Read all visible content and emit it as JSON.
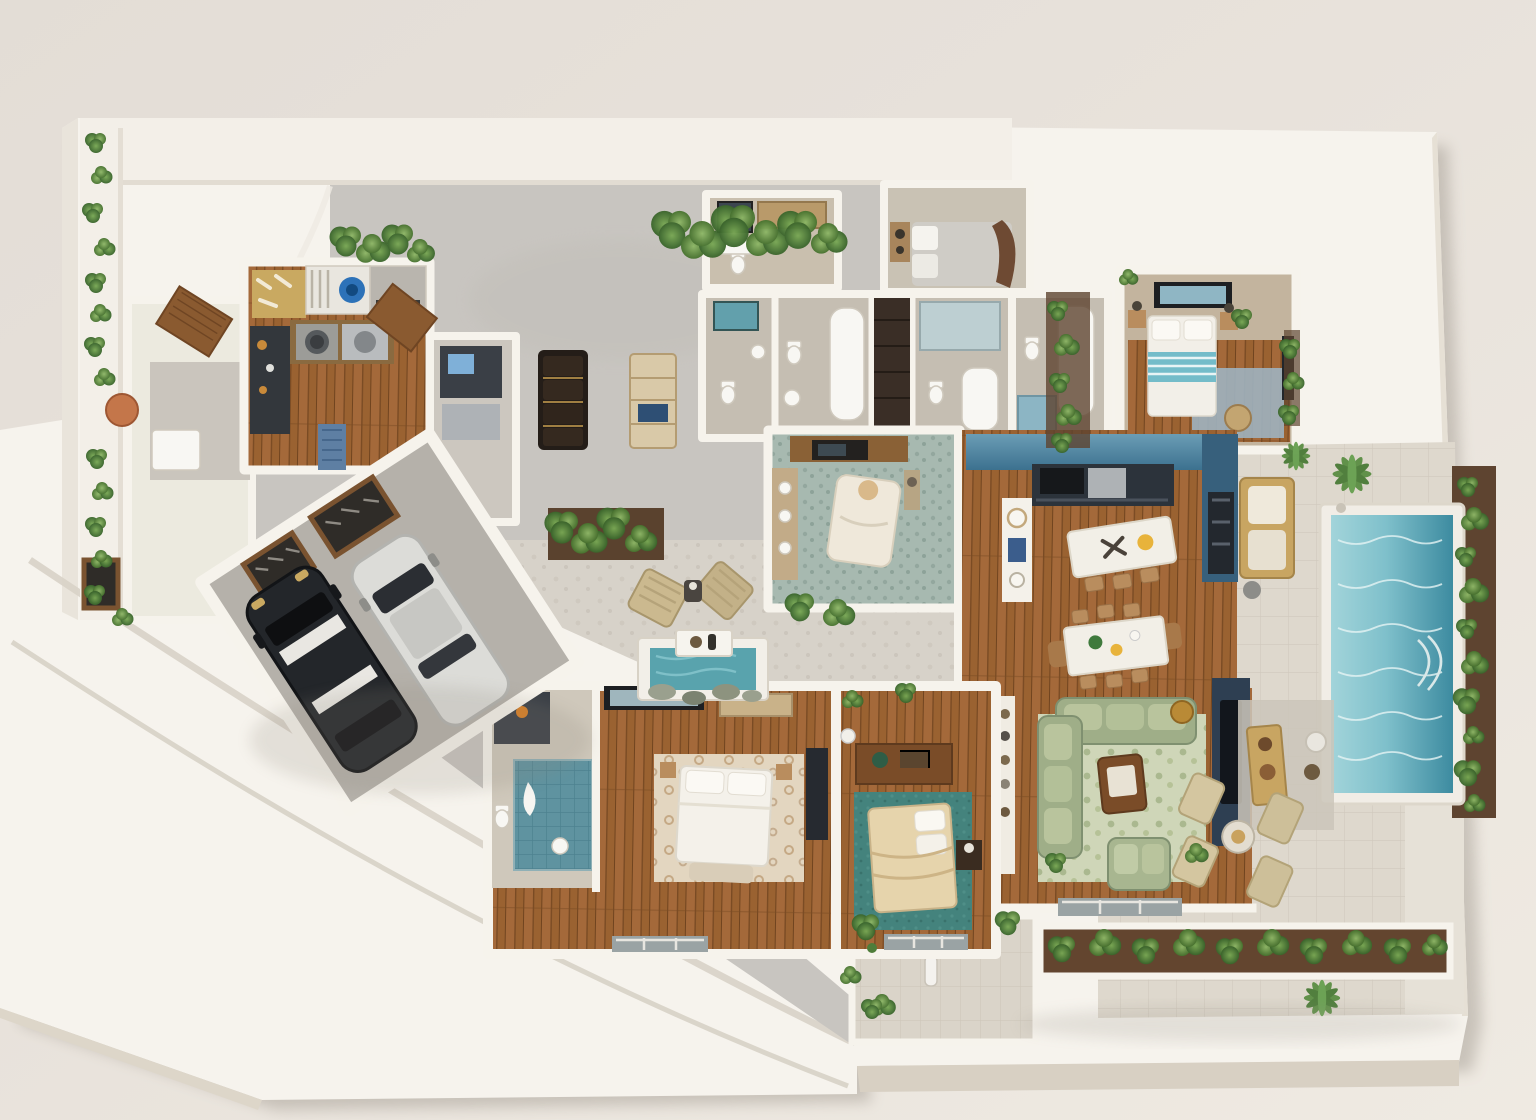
{
  "scene": {
    "title": "Top-down 3D rendered floor-plan model of a modern single-story villa",
    "view": "isometric top-down dollhouse render on a white presentation base"
  },
  "palette": {
    "background": "#e6e0d9",
    "base_plate": "#f6f3ed",
    "plate_edge": "#d8d0c3",
    "driveway_concrete": "#c8c5c0",
    "courtyard_tile": "#d7d2c9",
    "patio_tile": "#ded8cd",
    "wood_floor": "#9a6231",
    "wall_white": "#f6f3ec",
    "pool_shallow": "#a2d4da",
    "pool_deep": "#3d8ba0",
    "kitchen_blue": "#4e86a4",
    "cabinet_navy": "#2c333b",
    "tv_wall_navy": "#2e3f52",
    "sofa_green": "#a3b28c",
    "rug_living": "#cfd6b8",
    "rug_guest_teal": "#3e7a74",
    "bed_teal_stripe": "#74bcc9",
    "plant_green": "#4e7d3a",
    "terracotta_stool": "#c4764a",
    "car_suv_black": "#23262a",
    "car_sedan_white": "#dcdcd8"
  },
  "rooms": {
    "driveway": {
      "label": "Driveway"
    },
    "garage": {
      "label": "Garage — two cars"
    },
    "entry": {
      "label": "Entry hall with planters"
    },
    "kitchenette": {
      "label": "Kitchenette / laundry"
    },
    "utility": {
      "label": "Utility room"
    },
    "hall_bench": {
      "label": "Hallway bench seating"
    },
    "hall_shelf": {
      "label": "Hallway shelf cabinet"
    },
    "bath_cluster": {
      "label": "Bathroom cluster"
    },
    "bedroom_gray": {
      "label": "Bedroom — gray bed, leather headboard"
    },
    "bedroom_teal": {
      "label": "Bedroom — white bed with teal throw"
    },
    "study": {
      "label": "Study lounge with chaise"
    },
    "kitchen": {
      "label": "Kitchen — blue backsplash, island"
    },
    "dining": {
      "label": "Dining area"
    },
    "living": {
      "label": "Living room — green sectional"
    },
    "primary_bath": {
      "label": "Primary bathroom — teal tiled shower"
    },
    "primary_bedroom": {
      "label": "Primary bedroom"
    },
    "bedroom_guest": {
      "label": "Guest bedroom — teal rug"
    },
    "courtyard": {
      "label": "Inner courtyard with loungers and water feature"
    },
    "pool": {
      "label": "Swimming pool"
    },
    "pool_patio": {
      "label": "Pool patio and outdoor lounge"
    },
    "walkway": {
      "label": "Entry walkway with planter"
    }
  },
  "objects": {
    "suv": {
      "label": "Black SUV with white roof stripes"
    },
    "sedan": {
      "label": "White sedan"
    },
    "water_feature": {
      "label": "Courtyard reflecting pool"
    },
    "sculpture": {
      "label": "Walkway sculpture"
    },
    "loungers": {
      "label": "Outdoor lounge chairs"
    },
    "plants": {
      "label": "Landscaping plants"
    }
  }
}
